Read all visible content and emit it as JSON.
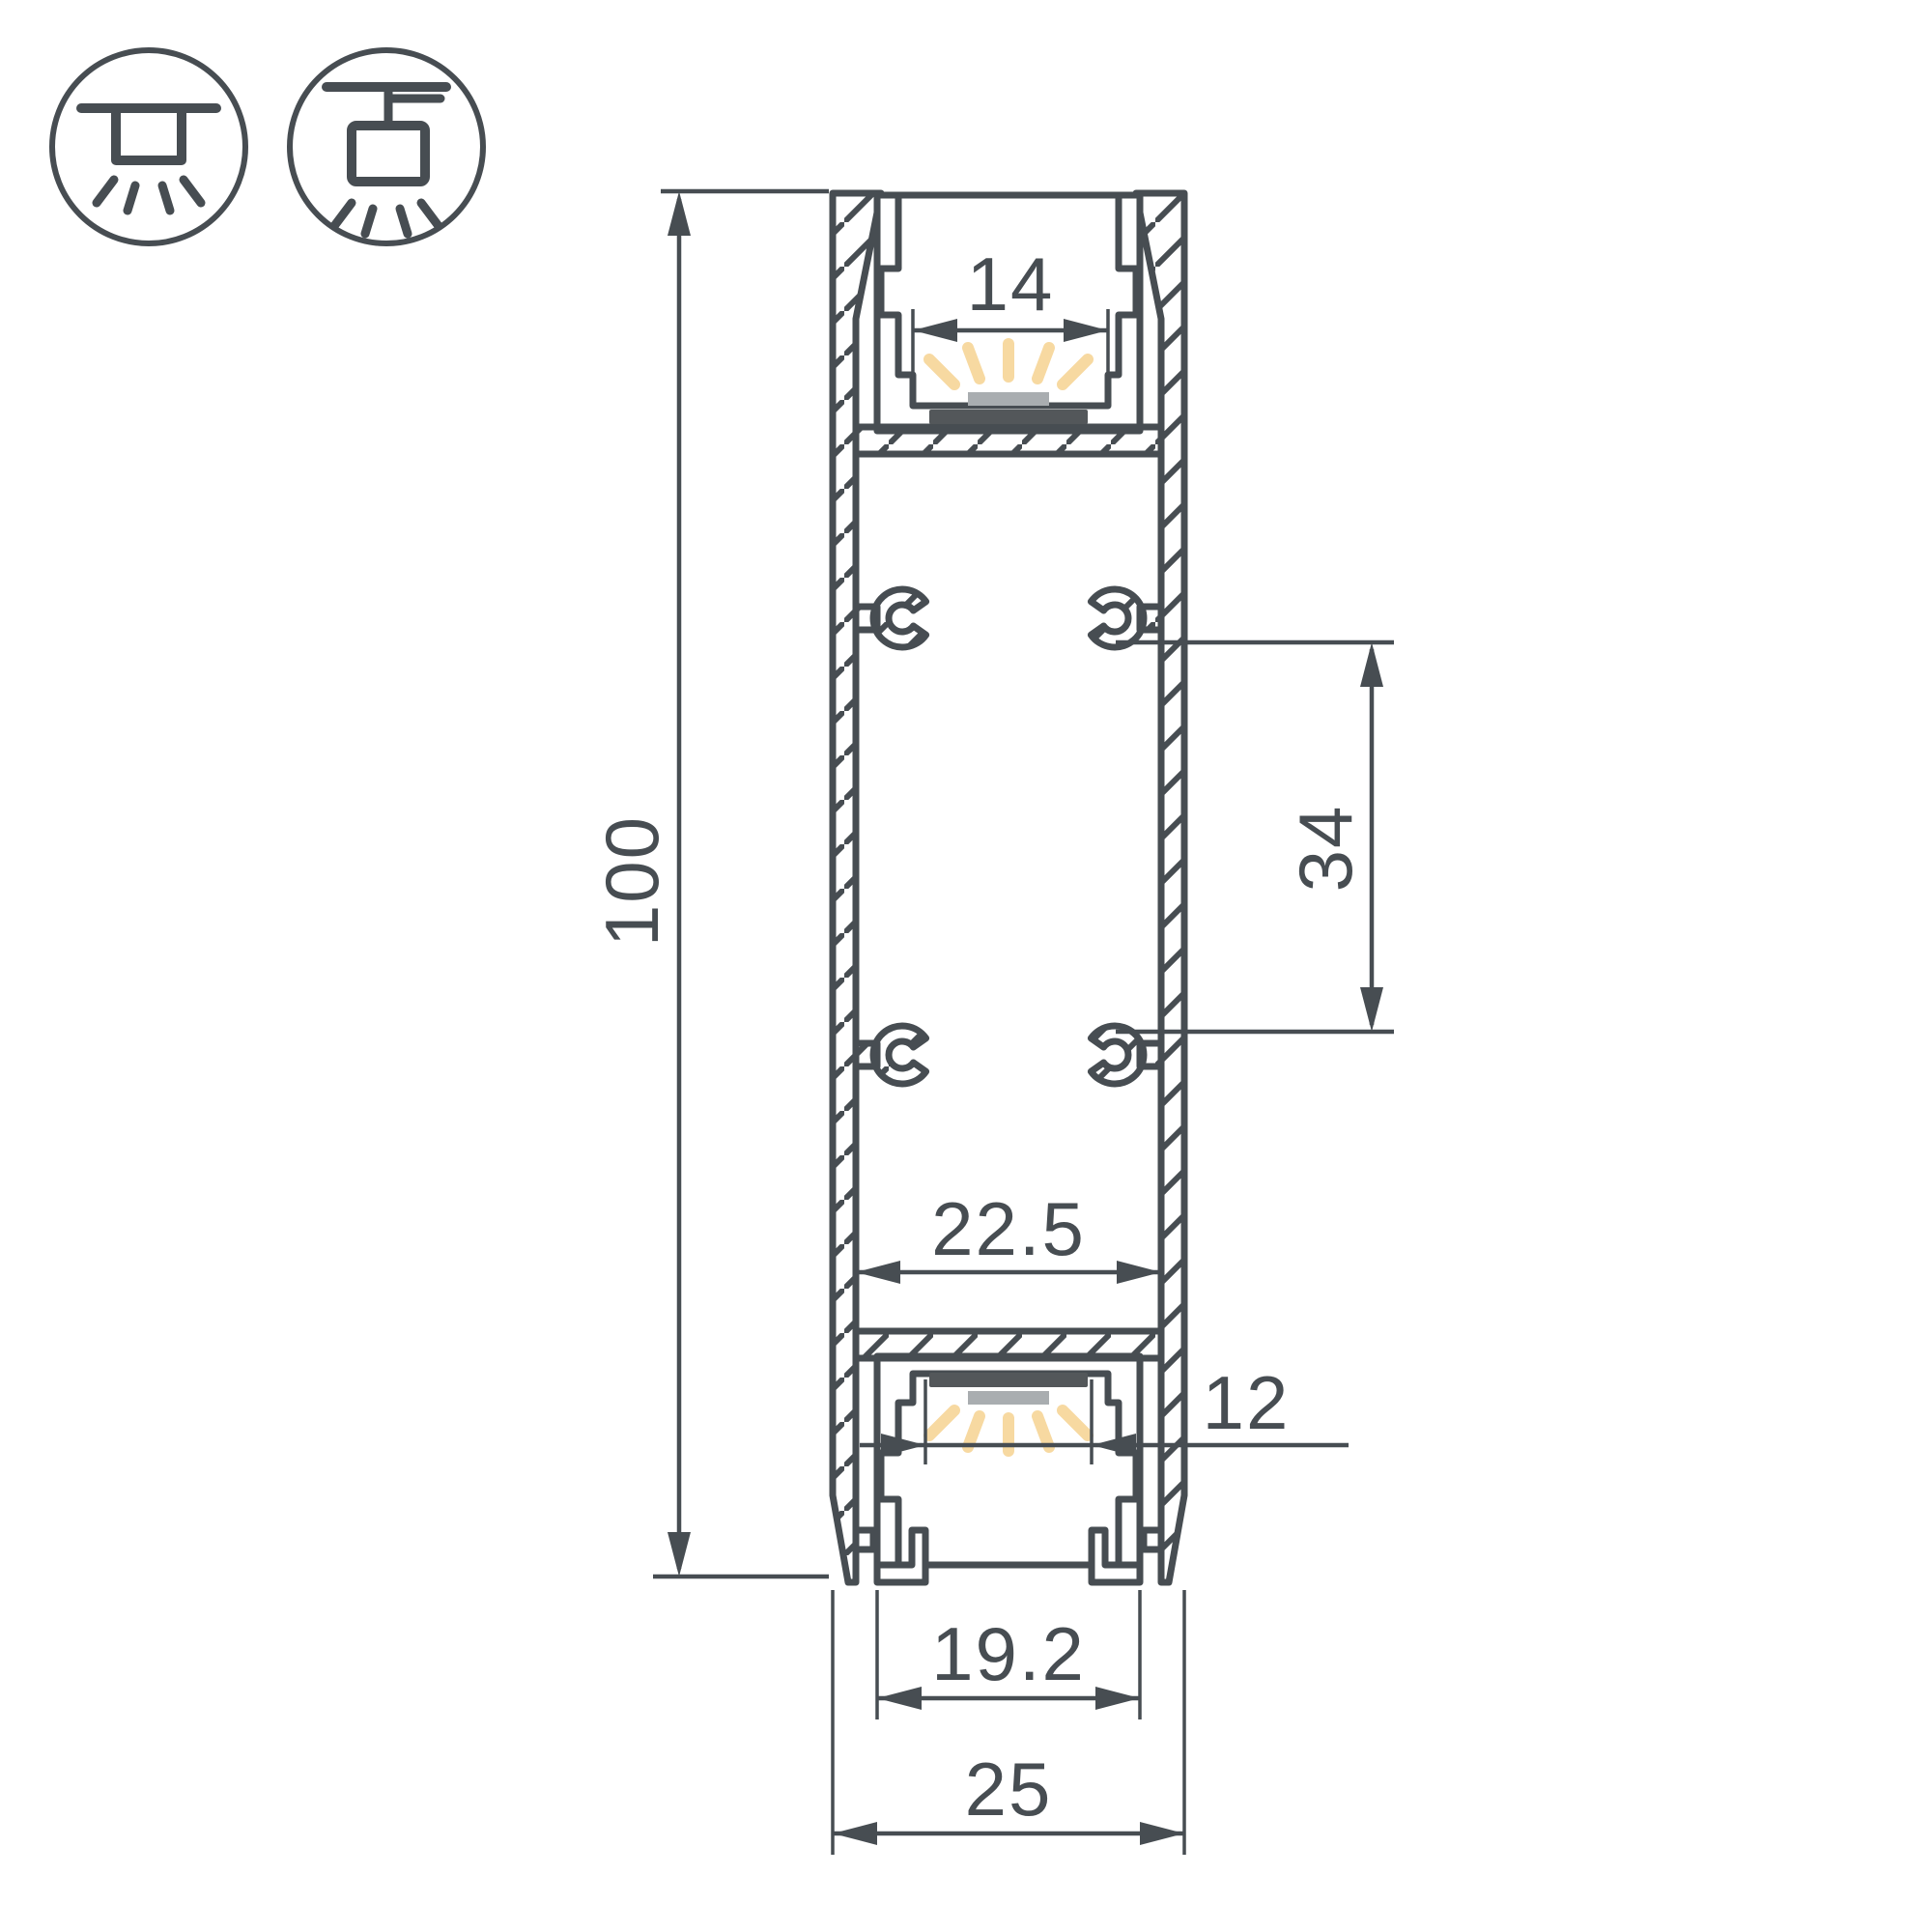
{
  "drawing": {
    "type": "technical-cross-section",
    "subject": "LED aluminium profile cross-section with mounting dimensions",
    "units": "mm",
    "dimensions": {
      "overall_height": {
        "label": "100"
      },
      "top_channel_opening": {
        "label": "14"
      },
      "mount_hole_spacing": {
        "label": "34"
      },
      "inner_cavity_width": {
        "label": "22.5"
      },
      "bottom_channel_opening": {
        "label": "12"
      },
      "bottom_channel_width": {
        "label": "19.2"
      },
      "overall_width": {
        "label": "25"
      }
    },
    "icons": [
      {
        "name": "recessed-ceiling-mount-icon"
      },
      {
        "name": "surface-pendant-mount-icon"
      }
    ],
    "colors": {
      "stroke": "#474d52",
      "aluminum_fill": "#e9ebec",
      "led_strip": "#53575a",
      "diffuser": "#a9adb0",
      "light_rays": "#f7d9a1",
      "background": "#ffffff"
    }
  }
}
